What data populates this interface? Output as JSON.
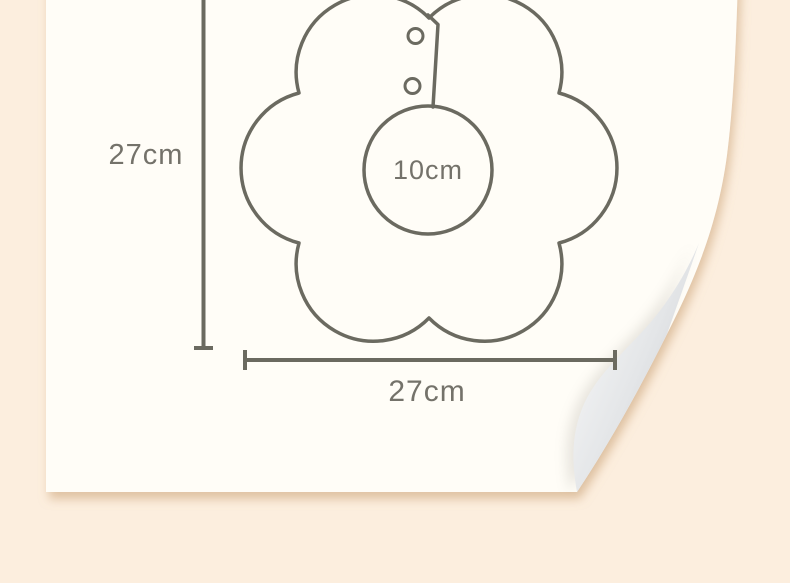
{
  "diagram": {
    "height_label": "27cm",
    "width_label": "27cm",
    "neck_label": "10cm"
  },
  "colors": {
    "background": "#fceede",
    "card": "#fffdf7",
    "line": "#6b6a60",
    "label_text": "#74726a",
    "curl_light": "#fdfdfd",
    "curl_mid": "#e4e6e8",
    "curl_dark": "#c6c9ce",
    "shadow": "#c89e6f"
  }
}
